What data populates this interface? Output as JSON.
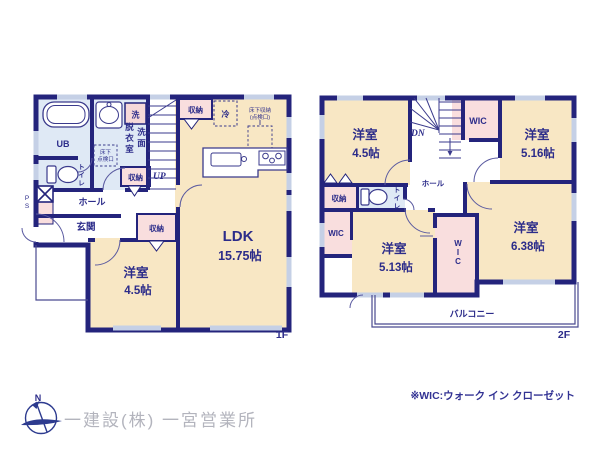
{
  "f1": {
    "floor_label": "1F",
    "ub": "UB",
    "wash": "洗",
    "datsui": "脱衣室",
    "senmen": "洗面",
    "tenken_l1": "床下",
    "tenken_l2": "点検口",
    "toilet": "トイレ",
    "up": "UP",
    "shuno_stairs": "収納",
    "rei": "冷",
    "yukashita_l1": "床下収納",
    "yukashita_l2": "(点検口)",
    "shuno_hall": "収納",
    "hall": "ホール",
    "genkan": "玄関",
    "shuno_genkan": "収納",
    "ps": "PS",
    "ldk": {
      "name": "LDK",
      "size": "15.75帖"
    },
    "yoshitsu": {
      "name": "洋室",
      "size": "4.5帖"
    }
  },
  "f2": {
    "floor_label": "2F",
    "dn": "DN",
    "hall": "ホール",
    "wic_top": "WIC",
    "shuno": "収納",
    "toilet": "トイレ",
    "wic_left": "WIC",
    "wic_mid": "WIC",
    "room_tl": {
      "name": "洋室",
      "size": "4.5帖"
    },
    "room_tr": {
      "name": "洋室",
      "size": "5.16帖"
    },
    "room_br": {
      "name": "洋室",
      "size": "6.38帖"
    },
    "room_bl": {
      "name": "洋室",
      "size": "5.13帖"
    },
    "balcony": "バルコニー"
  },
  "footer": {
    "compass_n": "N",
    "company": "一建設(株) 一宮営業所",
    "wic_note": "※WIC:ウォーク イン クローゼット"
  },
  "colors": {
    "wall": "#24247c",
    "room_tan": "#f8e7c4",
    "room_blue": "#dfe9f5",
    "room_pink": "#f9dede",
    "window": "#c5d0e6"
  }
}
